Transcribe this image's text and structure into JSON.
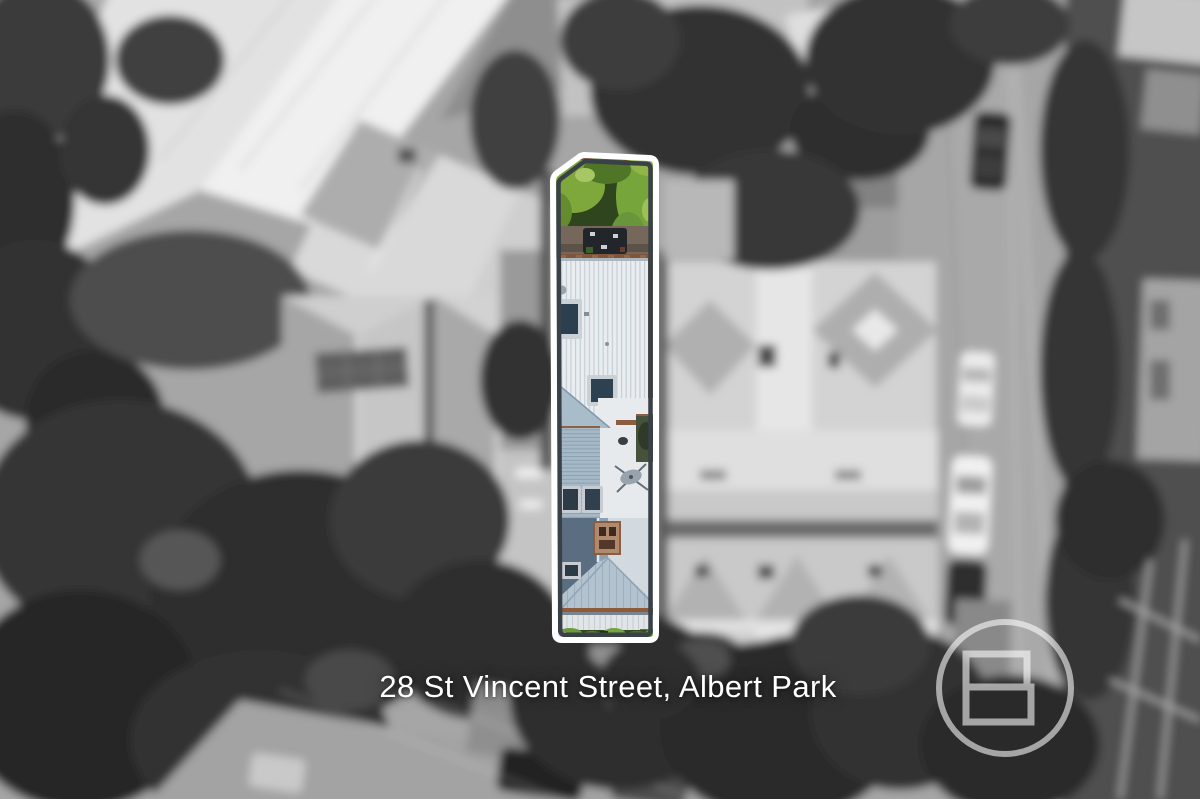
{
  "caption": {
    "address": "28 St Vincent Street, Albert Park"
  },
  "branding": {
    "logo_icon": "circle-geometric-b-icon",
    "logo_color": "#ffffff",
    "logo_opacity": "0.58"
  },
  "highlight": {
    "outline_outer_color": "#ffffff",
    "outline_inner_color": "#3a4047"
  },
  "scene": {
    "type": "aerial-drone-photo",
    "effect": "surroundings blurred and desaturated, highlighted lot in colour",
    "property_features": [
      "rear-garden-trees",
      "outdoor-dining-setting",
      "standing-seam-metal-roof",
      "skylights",
      "corrugated-roof-section",
      "satellite-dish",
      "brick-chimney",
      "hip-roof",
      "front-veranda",
      "front-hedge"
    ]
  },
  "palette": {
    "background_gray": "#a6a6a6",
    "tree_dark": "#2f2f2f",
    "roof_silver": "#e9edf0",
    "roof_blue_gray": "#a6b9c7",
    "garden_green": "#6c9c3a",
    "paving_brown": "#75675a",
    "brick_red": "#7e553d"
  }
}
